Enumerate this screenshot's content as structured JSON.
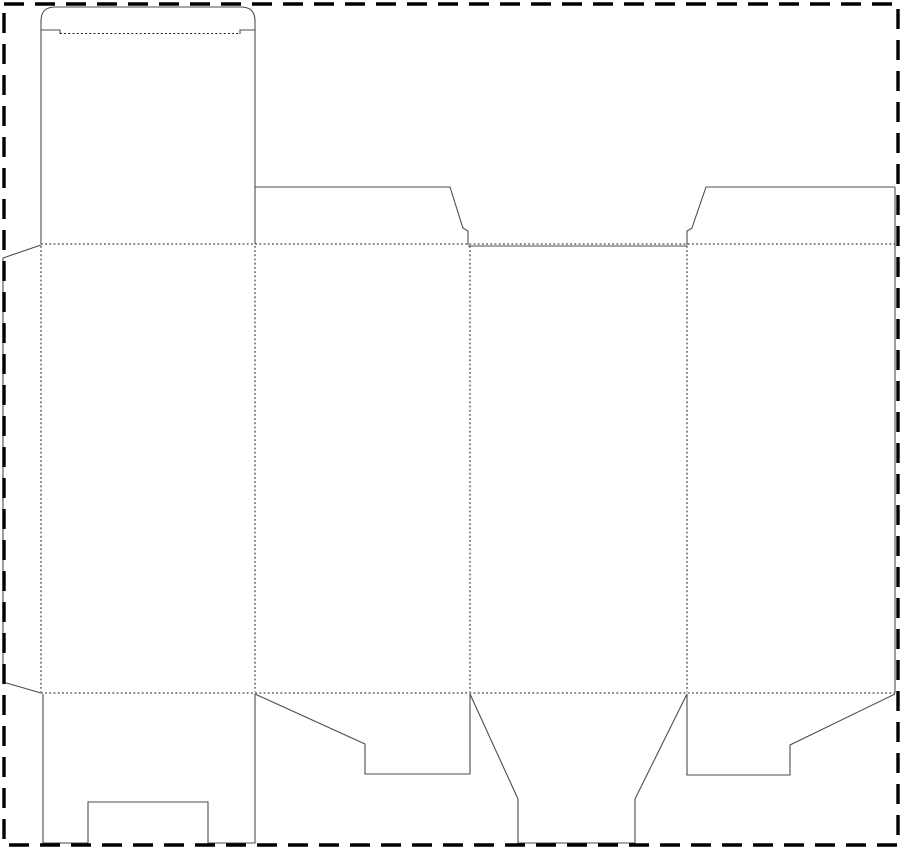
{
  "meta": {
    "type": "packaging-dieline",
    "description": "Blank folding-carton die-cut template: four panels with glue flap, tuck lid, dust flaps and notched bottom lid. Solid lines are cuts, dotted lines are folds, dashed rectangle is the sheet boundary."
  },
  "canvas": {
    "width": 900,
    "height": 847
  },
  "colors": {
    "cut": "#4d4d4d",
    "fold": "#111111",
    "border": "#000000",
    "bg": "#ffffff"
  },
  "border": {
    "path": "M4 4 L898 4 L898 845 L4 845 Z"
  },
  "dieline": {
    "cuts": {
      "glue_flap_outline": "M41 245 L3 258 L3 682 L41 693",
      "lid_and_tuck_outline": "M41 244 L41 21 Q41 7 55 7 L241 7 Q255 7 255 21 L255 244",
      "tuck_shoulder_left": "M41 30 L60 30 L60 34",
      "tuck_shoulder_right": "M240 34 L240 30 L255 30",
      "top_flap_panel2_outline": "M255 187 L450 187 L461 222 L463 228 L468 231 L468 245",
      "top_edge_panel3_cut": "M468 246 L687 246",
      "top_flap_panel4_outline": "M687 245 L687 231 L692 228 L694 222 L706 187 L895 187",
      "right_edge_cut": "M895 187 L895 693",
      "bottom_lid_panel1_outline": "M43 694 L43 843 L88 843 L88 802 L208 802 L208 843 L255 843 L255 694",
      "bottom_flap_panel2_outline": "M255 694 L365 744 L365 774 L470 774 L470 694",
      "bottom_tuck_panel3_outline": "M470 694 L518 799 L518 843 L635 843 L635 799 L687 694",
      "bottom_flap_panel4_outline": "M687 694 L687 775 L790 775 L790 745 L895 694"
    },
    "folds": {
      "tuck_flap_fold": "M60 33.5 L240 33.5",
      "top_main_fold": "M41 244 L895 244",
      "bottom_main_fold": "M41 693 L895 693",
      "glue_flap_fold": "M41 246 L41 692",
      "panel1_panel2_fold": "M255 246 L255 692",
      "panel2_panel3_fold": "M470 246 L470 692",
      "panel3_panel4_fold": "M687 246 L687 692"
    }
  }
}
